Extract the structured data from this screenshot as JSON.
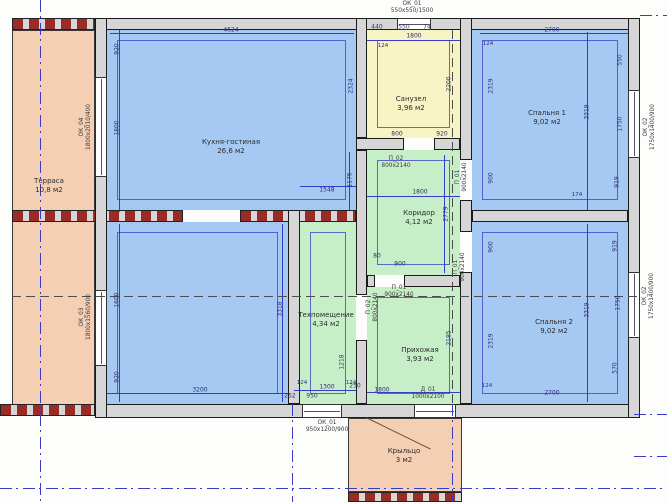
{
  "plan": {
    "colors": {
      "room_blue": "#a6c9f3",
      "room_green": "#c6efc8",
      "room_yellow": "#f7f3c3",
      "room_salmon": "#f5cfb4",
      "wall_gray": "#d6d6d6",
      "hatch_red": "#9b2b26",
      "dim_blue": "#3a3ac8"
    },
    "rooms": [
      {
        "name": "terrace",
        "label": "Терраса",
        "area": "10,8 м2",
        "rect": [
          12,
          30,
          83,
          376
        ],
        "label_pos": [
          49,
          186
        ],
        "color": "#f5cfb4",
        "inset": false,
        "outline": true
      },
      {
        "name": "kitchen-living",
        "label": "Кухня-гостиная",
        "area": "26,6 м2",
        "rect": [
          107,
          30,
          249,
          180
        ],
        "label_pos": [
          231,
          147
        ],
        "color": "#a6c9f3",
        "inset": true,
        "outline": false
      },
      {
        "name": "kitchen-living-lower",
        "label": "",
        "area": "",
        "rect": [
          107,
          222,
          181,
          182
        ],
        "label_pos": [
          0,
          0
        ],
        "color": "#a6c9f3",
        "inset": true,
        "outline": false
      },
      {
        "name": "bathroom",
        "label": "Санузел",
        "area": "3,96 м2",
        "rect": [
          367,
          30,
          93,
          108
        ],
        "label_pos": [
          411,
          104
        ],
        "color": "#f7f3c3",
        "inset": true,
        "outline": false
      },
      {
        "name": "bedroom-1",
        "label": "Спальня 1",
        "area": "9,02 м2",
        "rect": [
          472,
          30,
          156,
          180
        ],
        "label_pos": [
          547,
          118
        ],
        "color": "#a6c9f3",
        "inset": true,
        "outline": false
      },
      {
        "name": "bedroom-2",
        "label": "Спальня 2",
        "area": "9,02 м2",
        "rect": [
          472,
          222,
          156,
          182
        ],
        "label_pos": [
          554,
          327
        ],
        "color": "#a6c9f3",
        "inset": true,
        "outline": false
      },
      {
        "name": "corridor",
        "label": "Коридор",
        "area": "4,12 м2",
        "rect": [
          367,
          150,
          93,
          125
        ],
        "label_pos": [
          419,
          218
        ],
        "color": "#c6efc8",
        "inset": true,
        "outline": false
      },
      {
        "name": "tech-room",
        "label": "Техпомещение",
        "area": "4,34 м2",
        "rect": [
          300,
          222,
          56,
          182
        ],
        "label_pos": [
          326,
          320
        ],
        "color": "#c6efc8",
        "inset": true,
        "outline": false
      },
      {
        "name": "hallway",
        "label": "Прихожая",
        "area": "3,93 м2",
        "rect": [
          367,
          287,
          93,
          117
        ],
        "label_pos": [
          420,
          355
        ],
        "color": "#c6efc8",
        "inset": true,
        "outline": false
      },
      {
        "name": "porch",
        "label": "Крыльцо",
        "area": "3 м2",
        "rect": [
          348,
          418,
          114,
          74
        ],
        "label_pos": [
          404,
          456
        ],
        "color": "#f5cfb4",
        "inset": false,
        "outline": true
      }
    ],
    "walls": [
      {
        "name": "wall-top",
        "rect": [
          95,
          18,
          545,
          12
        ]
      },
      {
        "name": "wall-bottom",
        "rect": [
          95,
          404,
          545,
          14
        ]
      },
      {
        "name": "wall-left",
        "rect": [
          95,
          18,
          12,
          400
        ]
      },
      {
        "name": "wall-right",
        "rect": [
          628,
          18,
          12,
          400
        ]
      },
      {
        "name": "wall-bath-left",
        "rect": [
          356,
          18,
          11,
          120
        ]
      },
      {
        "name": "wall-corridor-left",
        "rect": [
          356,
          150,
          11,
          145
        ]
      },
      {
        "name": "wall-hall-left",
        "rect": [
          356,
          340,
          11,
          64
        ]
      },
      {
        "name": "wall-bath-bottom-a",
        "rect": [
          356,
          138,
          48,
          12
        ]
      },
      {
        "name": "wall-bath-bottom-b",
        "rect": [
          434,
          138,
          26,
          12
        ]
      },
      {
        "name": "wall-bedrooms-left-a",
        "rect": [
          460,
          18,
          12,
          142
        ]
      },
      {
        "name": "wall-bedrooms-left-b",
        "rect": [
          460,
          200,
          12,
          32
        ]
      },
      {
        "name": "wall-bedrooms-left-c",
        "rect": [
          460,
          272,
          12,
          132
        ]
      },
      {
        "name": "wall-bedrooms-separator",
        "rect": [
          472,
          210,
          156,
          12
        ]
      },
      {
        "name": "wall-kitchen-tech",
        "rect": [
          288,
          210,
          12,
          194
        ]
      },
      {
        "name": "wall-corridor-hall-a",
        "rect": [
          367,
          275,
          8,
          12
        ]
      },
      {
        "name": "wall-corridor-hall-b",
        "rect": [
          404,
          275,
          56,
          12
        ]
      }
    ],
    "hatches": [
      {
        "name": "hatch-terrace-top",
        "rect": [
          12,
          18,
          83,
          12
        ]
      },
      {
        "name": "hatch-terrace-bottom",
        "rect": [
          0,
          404,
          95,
          12
        ]
      },
      {
        "name": "hatch-mid-wall-left",
        "rect": [
          12,
          210,
          171,
          12
        ]
      },
      {
        "name": "hatch-mid-wall-right",
        "rect": [
          240,
          210,
          116,
          12
        ]
      },
      {
        "name": "hatch-porch-bottom",
        "rect": [
          348,
          492,
          114,
          10
        ]
      }
    ],
    "windows": [
      {
        "name": "window-ok01-top",
        "rect": [
          397,
          18,
          34,
          12
        ],
        "orient": "h"
      },
      {
        "name": "window-ok04-left",
        "rect": [
          95,
          77,
          12,
          100
        ],
        "orient": "v"
      },
      {
        "name": "window-ok03-left",
        "rect": [
          95,
          290,
          12,
          76
        ],
        "orient": "v"
      },
      {
        "name": "window-ok02-bedroom1",
        "rect": [
          628,
          90,
          12,
          68
        ],
        "orient": "v"
      },
      {
        "name": "window-ok02-bedroom2",
        "rect": [
          628,
          272,
          12,
          66
        ],
        "orient": "v"
      },
      {
        "name": "window-ok01-bottom",
        "rect": [
          302,
          404,
          40,
          14
        ],
        "orient": "h"
      },
      {
        "name": "door-d01-entrance",
        "rect": [
          414,
          404,
          42,
          14
        ],
        "orient": "h"
      }
    ],
    "axes": [
      {
        "name": "axis-vertical-left",
        "rect": [
          40,
          0,
          1,
          502
        ],
        "dir": "v",
        "style": "blue"
      },
      {
        "name": "axis-horizontal-bottom",
        "rect": [
          0,
          488,
          667,
          1
        ],
        "dir": "h",
        "style": "blue"
      },
      {
        "name": "axis-vertical-porch-left",
        "rect": [
          292,
          404,
          1,
          98
        ],
        "dir": "v",
        "style": "blue"
      },
      {
        "name": "axis-vertical-center-dark",
        "rect": [
          452,
          30,
          1,
          374
        ],
        "dir": "v",
        "style": "dark"
      },
      {
        "name": "axis-vertical-center-low",
        "rect": [
          452,
          404,
          1,
          98
        ],
        "dir": "v",
        "style": "blue"
      },
      {
        "name": "axis-horizontal-center-dark",
        "rect": [
          12,
          296,
          628,
          1
        ],
        "dir": "h",
        "style": "dark"
      },
      {
        "name": "axis-stub-right-1",
        "rect": [
          634,
          414,
          33,
          1
        ],
        "dir": "h",
        "style": "blue"
      },
      {
        "name": "axis-stub-right-2",
        "rect": [
          634,
          456,
          33,
          1
        ],
        "dir": "h",
        "style": "blue"
      },
      {
        "name": "axis-stub-top-right",
        "rect": [
          640,
          15,
          27,
          1
        ],
        "dir": "h",
        "style": "blue"
      }
    ],
    "dim_lines": [
      {
        "rect": [
          110,
          33,
          244,
          1
        ]
      },
      {
        "rect": [
          480,
          33,
          148,
          1
        ]
      },
      {
        "rect": [
          367,
          40,
          93,
          1
        ]
      },
      {
        "rect": [
          119,
          30,
          1,
          182
        ]
      },
      {
        "rect": [
          119,
          224,
          1,
          178
        ]
      },
      {
        "rect": [
          107,
          393,
          181,
          1
        ]
      },
      {
        "rect": [
          294,
          390,
          62,
          1
        ]
      },
      {
        "rect": [
          367,
          392,
          93,
          1
        ]
      },
      {
        "rect": [
          367,
          196,
          93,
          1
        ]
      },
      {
        "rect": [
          444,
          155,
          1,
          118
        ]
      },
      {
        "rect": [
          587,
          32,
          1,
          178
        ]
      },
      {
        "rect": [
          587,
          224,
          1,
          178
        ]
      },
      {
        "rect": [
          282,
          224,
          1,
          178
        ]
      },
      {
        "rect": [
          349,
          152,
          1,
          58
        ]
      },
      {
        "rect": [
          300,
          186,
          56,
          1
        ]
      }
    ],
    "dims": [
      {
        "t": "4624",
        "x": 231,
        "y": 30,
        "r": 0
      },
      {
        "t": "440",
        "x": 377,
        "y": 27,
        "r": 0
      },
      {
        "t": "550",
        "x": 404,
        "y": 27,
        "r": 0
      },
      {
        "t": "74",
        "x": 427,
        "y": 27,
        "r": 0
      },
      {
        "t": "1800",
        "x": 414,
        "y": 36,
        "r": 0
      },
      {
        "t": "2700",
        "x": 552,
        "y": 30,
        "r": 0
      },
      {
        "t": "920",
        "x": 117,
        "y": 49,
        "r": 1
      },
      {
        "t": "1800",
        "x": 117,
        "y": 128,
        "r": 1
      },
      {
        "t": "1600",
        "x": 117,
        "y": 300,
        "r": 1
      },
      {
        "t": "920",
        "x": 117,
        "y": 377,
        "r": 1
      },
      {
        "t": "2324",
        "x": 351,
        "y": 86,
        "r": 1
      },
      {
        "t": "2200",
        "x": 449,
        "y": 84,
        "r": 1
      },
      {
        "t": "1176",
        "x": 350,
        "y": 180,
        "r": 1
      },
      {
        "t": "1548",
        "x": 327,
        "y": 190,
        "r": 0
      },
      {
        "t": "3318",
        "x": 280,
        "y": 309,
        "r": 1
      },
      {
        "t": "3200",
        "x": 200,
        "y": 390,
        "r": 0
      },
      {
        "t": "1300",
        "x": 327,
        "y": 387,
        "r": 0
      },
      {
        "t": "252",
        "x": 290,
        "y": 396,
        "r": 0
      },
      {
        "t": "950",
        "x": 312,
        "y": 396,
        "r": 0
      },
      {
        "t": "250",
        "x": 355,
        "y": 386,
        "r": 0
      },
      {
        "t": "1218",
        "x": 342,
        "y": 362,
        "r": 1
      },
      {
        "t": "800",
        "x": 397,
        "y": 134,
        "r": 0
      },
      {
        "t": "920",
        "x": 442,
        "y": 134,
        "r": 0
      },
      {
        "t": "1800",
        "x": 420,
        "y": 192,
        "r": 0
      },
      {
        "t": "2779",
        "x": 446,
        "y": 214,
        "r": 1
      },
      {
        "t": "900",
        "x": 400,
        "y": 264,
        "r": 0
      },
      {
        "t": "80",
        "x": 377,
        "y": 256,
        "r": 0
      },
      {
        "t": "1800",
        "x": 382,
        "y": 390,
        "r": 0
      },
      {
        "t": "2185",
        "x": 449,
        "y": 338,
        "r": 1
      },
      {
        "t": "2319",
        "x": 491,
        "y": 86,
        "r": 1
      },
      {
        "t": "900",
        "x": 491,
        "y": 178,
        "r": 1
      },
      {
        "t": "3319",
        "x": 587,
        "y": 112,
        "r": 1
      },
      {
        "t": "550",
        "x": 620,
        "y": 60,
        "r": 1
      },
      {
        "t": "1750",
        "x": 620,
        "y": 124,
        "r": 1
      },
      {
        "t": "919",
        "x": 617,
        "y": 182,
        "r": 1
      },
      {
        "t": "900",
        "x": 491,
        "y": 247,
        "r": 1
      },
      {
        "t": "2319",
        "x": 491,
        "y": 341,
        "r": 1
      },
      {
        "t": "3319",
        "x": 587,
        "y": 310,
        "r": 1
      },
      {
        "t": "919",
        "x": 615,
        "y": 246,
        "r": 1
      },
      {
        "t": "1750",
        "x": 618,
        "y": 303,
        "r": 1
      },
      {
        "t": "570",
        "x": 615,
        "y": 368,
        "r": 1
      },
      {
        "t": "2700",
        "x": 552,
        "y": 393,
        "r": 0
      }
    ],
    "tags": [
      {
        "name": "tag-window-ok01-top",
        "t": "ОК_01\n550х550/1500",
        "x": 412,
        "y": 8,
        "r": 0
      },
      {
        "name": "tag-window-ok04",
        "t": "ОК_04\n1800х2010/400",
        "x": 86,
        "y": 127,
        "r": 1
      },
      {
        "name": "tag-window-ok03",
        "t": "ОК_03\n1800х1560/900",
        "x": 86,
        "y": 317,
        "r": 1
      },
      {
        "name": "tag-window-ok02-bedroom1",
        "t": "ОК_02\n1750х1400/900",
        "x": 650,
        "y": 127,
        "r": 1
      },
      {
        "name": "tag-window-ok02-bedroom2",
        "t": "ОК_02\n1750х1400/900",
        "x": 649,
        "y": 296,
        "r": 1
      },
      {
        "name": "tag-window-ok01-bottom",
        "t": "ОК_01\n950х1200/900",
        "x": 327,
        "y": 427,
        "r": 0
      },
      {
        "name": "tag-door-d01",
        "t": "Д_01\n1000х2100",
        "x": 428,
        "y": 394,
        "r": 0
      },
      {
        "name": "tag-door-p02-bathroom",
        "t": "П_02\n800х2140",
        "x": 396,
        "y": 163,
        "r": 0
      },
      {
        "name": "tag-door-p01-bedroom1",
        "t": "П_01\n900х2140",
        "x": 462,
        "y": 177,
        "r": 1
      },
      {
        "name": "tag-door-p01-bedroom2",
        "t": "П_01\n900х2140",
        "x": 460,
        "y": 267,
        "r": 1
      },
      {
        "name": "tag-door-p01-hallway",
        "t": "П_01\n900х2140",
        "x": 399,
        "y": 292,
        "r": 0
      },
      {
        "name": "tag-door-p02-tech",
        "t": "П_02\n800х2140",
        "x": 373,
        "y": 307,
        "r": 1
      }
    ],
    "markers": [
      {
        "t": "124",
        "x": 383,
        "y": 46
      },
      {
        "t": "124",
        "x": 488,
        "y": 44
      },
      {
        "t": "124",
        "x": 302,
        "y": 383
      },
      {
        "t": "124",
        "x": 351,
        "y": 383
      },
      {
        "t": "124",
        "x": 487,
        "y": 386
      },
      {
        "t": "174",
        "x": 577,
        "y": 195
      }
    ],
    "diagonals": [
      {
        "name": "porch-leader-line",
        "x": 366,
        "y": 417,
        "len": 72,
        "angle": 26
      }
    ]
  }
}
